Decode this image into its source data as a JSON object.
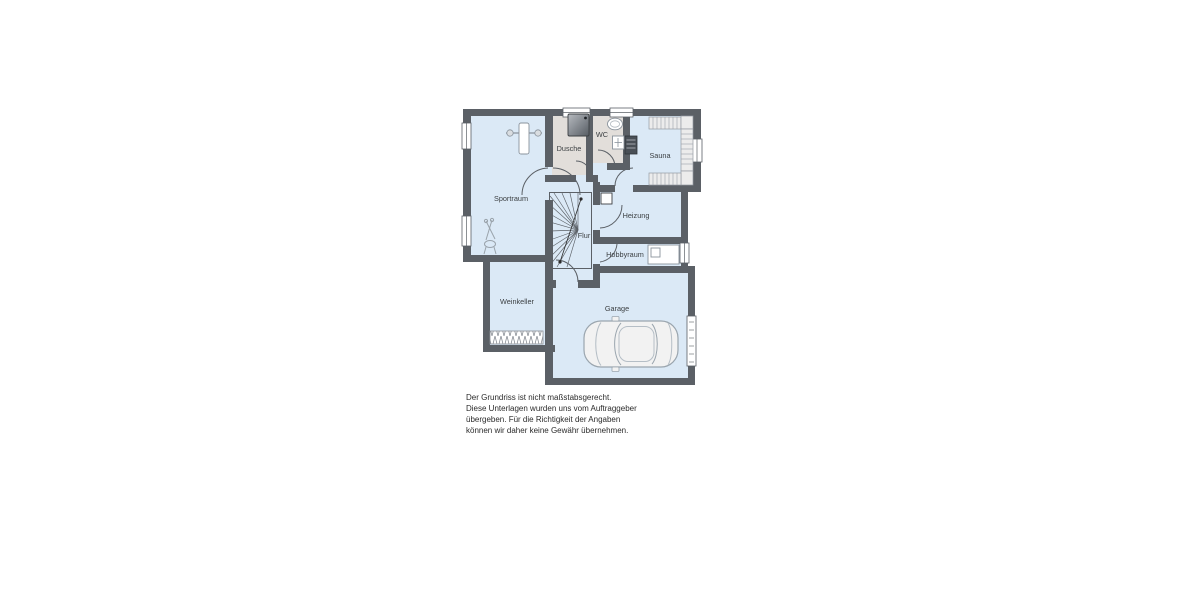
{
  "plan": {
    "type": "floor-plan-basement",
    "rooms": {
      "sportraum": {
        "label": "Sportraum"
      },
      "dusche": {
        "label": "Dusche"
      },
      "wc": {
        "label": "WC"
      },
      "sauna": {
        "label": "Sauna"
      },
      "heizung": {
        "label": "Heizung"
      },
      "flur": {
        "label": "Flur"
      },
      "hobbyraum": {
        "label": "Hobbyraum"
      },
      "weinkeller": {
        "label": "Weinkeller"
      },
      "garage": {
        "label": "Garage"
      }
    },
    "colors": {
      "wall": "#5b6066",
      "room_fill": "#dbe9f6",
      "wet_room_fill": "#e2deda",
      "furniture_outline": "#8a939c",
      "text": "#3c4043"
    }
  },
  "disclaimer": {
    "lines": [
      "Der Grundriss ist nicht maßstabsgerecht.",
      "Diese Unterlagen wurden uns vom Auftraggeber",
      "übergeben. Für die Richtigkeit der Angaben",
      "können wir daher keine Gewähr übernehmen."
    ]
  }
}
